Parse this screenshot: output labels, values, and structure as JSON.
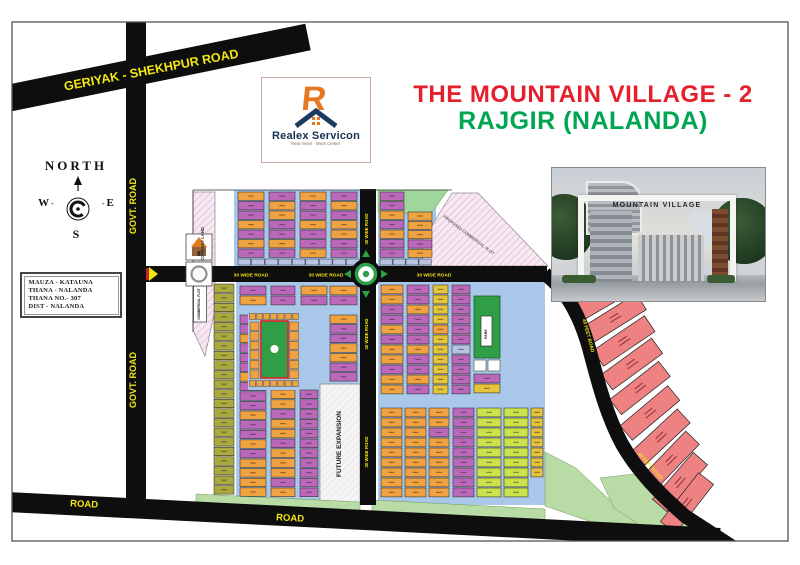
{
  "title": {
    "line1": "THE MOUNTAIN VILLAGE - 2",
    "line2": "RAJGIR (NALANDA)"
  },
  "logo": {
    "name": "Realex Servicon",
    "tagline": "Real Asset - Work Center"
  },
  "compass": {
    "north": "NORTH",
    "w": "W",
    "e": "E",
    "s": "S"
  },
  "info": {
    "lines": [
      "MAUZA - KATAUNA",
      "THANA - NALANDA",
      "THANA NO.- 307",
      "DIST - NALANDA"
    ]
  },
  "photo": {
    "caption": "MOUNTAIN VILLAGE"
  },
  "map": {
    "frame": {
      "x": 12,
      "y": 22,
      "w": 776,
      "h": 519
    },
    "colors": {
      "O": "#efa23f",
      "P": "#bb68bb",
      "Y": "#e5c33c",
      "G": "#cbe24a",
      "D": "#aaa83e",
      "R": "#ee8282",
      "B": "#a9c8e9",
      "L": "#b9c3e4",
      "W": "#ffffff",
      "LG": "#b9dca6",
      "LG2": "#9fd69b",
      "GR": "#2f9e47"
    },
    "blue_bgs": [
      [
        234,
        190,
        126,
        76
      ],
      [
        378,
        190,
        58,
        76
      ],
      [
        236,
        282,
        124,
        223
      ],
      [
        378,
        282,
        167,
        223
      ]
    ],
    "hatch_areas": [
      {
        "p": "pink",
        "pts": "193,192 215,192 215,310 205,356 193,330"
      },
      {
        "p": "pink",
        "pts": "423,266 423,240 452,193 478,193 548,266"
      },
      {
        "p": "pink",
        "pts": "548,270 575,300 590,330 597,358 589,358 566,306 544,280"
      },
      {
        "p": "gray",
        "pts": "320,384 360,384 360,503 320,503"
      }
    ],
    "green_areas": [
      {
        "f": "LG2",
        "pts": "378,190 448,190 431,214 378,212"
      },
      {
        "f": "LG",
        "pts": "196,494 360,502 360,513 196,507"
      },
      {
        "f": "LG",
        "pts": "372,500 545,509 545,522 372,513"
      },
      {
        "f": "LG",
        "pts": "545,452 576,468 612,502 658,527 638,538 545,506"
      },
      {
        "f": "LG",
        "pts": "600,478 652,472 696,524 658,537 614,508"
      }
    ],
    "strips": [
      {
        "x": 238,
        "y": 259,
        "w": 122,
        "h": 6,
        "n": 9,
        "f": "L"
      },
      {
        "x": 380,
        "y": 259,
        "w": 52,
        "h": 6,
        "n": 4,
        "f": "L"
      }
    ],
    "columns": [
      {
        "x": 238,
        "y": 192,
        "w": 26,
        "rh": 9.5,
        "pat": "OPPOPOP"
      },
      {
        "x": 269,
        "y": 192,
        "w": 26,
        "rh": 9.5,
        "pat": "POOPPOP"
      },
      {
        "x": 300,
        "y": 192,
        "w": 26,
        "rh": 9.5,
        "pat": "OPPOPPO"
      },
      {
        "x": 331,
        "y": 192,
        "w": 26,
        "rh": 9.5,
        "pat": "POPOOPP"
      },
      {
        "x": 380,
        "y": 192,
        "w": 24,
        "rh": 9.5,
        "pat": "PPOPOPP"
      },
      {
        "x": 408,
        "y": 212,
        "w": 24,
        "rh": 9.3,
        "pat": "OOOPO"
      },
      {
        "x": 214,
        "y": 284,
        "w": 20,
        "rh": 9.6,
        "pat": "DDDDDDDDDDDDDDDDDDDDDD"
      },
      {
        "x": 240,
        "y": 286,
        "w": 26,
        "rh": 10,
        "pat": "PO"
      },
      {
        "x": 271,
        "y": 286,
        "w": 24,
        "rh": 10,
        "pat": "PP"
      },
      {
        "x": 301,
        "y": 286,
        "w": 26,
        "rh": 10,
        "pat": "OP"
      },
      {
        "x": 330,
        "y": 286,
        "w": 27,
        "rh": 10,
        "pat": "OP"
      },
      {
        "x": 240,
        "y": 315,
        "w": 26,
        "rh": 9.6,
        "pat": "PPOPPPOPPPOPPOPOOOO"
      },
      {
        "x": 330,
        "y": 315,
        "w": 27,
        "rh": 9.6,
        "pat": "OPPOOPP"
      },
      {
        "x": 271,
        "y": 390,
        "w": 24,
        "rh": 9.8,
        "pat": "OOPOOPOOOPO"
      },
      {
        "x": 300,
        "y": 390,
        "w": 18,
        "rh": 9.8,
        "pat": "PPPPPPPPPPP"
      },
      {
        "x": 381,
        "y": 285,
        "w": 22,
        "rh": 10,
        "pat": "OOPPOPOOPOO"
      },
      {
        "x": 407,
        "y": 285,
        "w": 22,
        "rh": 10,
        "pat": "PPOPPPOPPOP"
      },
      {
        "x": 433,
        "y": 285,
        "w": 15,
        "rh": 10,
        "pat": "YYYYOYYYYYY"
      },
      {
        "x": 452,
        "y": 285,
        "w": 18,
        "rh": 10,
        "pat": "PPPPPPLPPPP"
      },
      {
        "x": 474,
        "y": 374,
        "w": 26,
        "rh": 10,
        "pat": "PY"
      },
      {
        "x": 381,
        "y": 408,
        "w": 21,
        "rh": 10,
        "pat": "OOOOOOOOO"
      },
      {
        "x": 405,
        "y": 408,
        "w": 21,
        "rh": 10,
        "pat": "OOOOOOOOO"
      },
      {
        "x": 429,
        "y": 408,
        "w": 20,
        "rh": 10,
        "pat": "OOPOOOOOO"
      },
      {
        "x": 453,
        "y": 408,
        "w": 21,
        "rh": 10,
        "pat": "PPPPPPPPP"
      },
      {
        "x": 477,
        "y": 408,
        "w": 24,
        "rh": 10,
        "pat": "GGGGGGGGG"
      },
      {
        "x": 504,
        "y": 408,
        "w": 24,
        "rh": 10,
        "pat": "GGGGGGGGG"
      },
      {
        "x": 531,
        "y": 408,
        "w": 12,
        "rh": 10,
        "pat": "YYYYYYY"
      }
    ],
    "cells": [
      [
        474,
        360,
        12,
        11,
        "W"
      ],
      [
        488,
        360,
        12,
        11,
        "W"
      ]
    ],
    "park": {
      "bg": [
        248,
        312,
        52,
        78
      ],
      "green": [
        261,
        321,
        27,
        57
      ],
      "circle": [
        274.5,
        349,
        4
      ]
    },
    "green_plot": [
      474,
      296,
      26,
      62
    ],
    "white_boxes": [
      [
        193.5,
        286,
        13,
        36
      ],
      [
        481,
        316,
        11,
        30
      ]
    ],
    "farm": {
      "w": 62,
      "h": 19,
      "plots": [
        [
          606,
          296,
          -30
        ],
        [
          615,
          318,
          -32
        ],
        [
          624,
          341,
          -34
        ],
        [
          632,
          364,
          -36
        ],
        [
          640,
          388,
          -38
        ],
        [
          650,
          413,
          -40
        ],
        [
          661,
          437,
          -43
        ],
        [
          671,
          460,
          -46
        ],
        [
          680,
          482,
          -49
        ],
        [
          687,
          503,
          -52
        ]
      ]
    },
    "road_lines": [
      {
        "x1": -5,
        "y1": 101,
        "x2": 308,
        "y2": 37,
        "w": 27
      },
      {
        "x1": 136,
        "y1": 22,
        "x2": 136,
        "y2": 514,
        "w": 20
      },
      {
        "x1": 146,
        "y1": 274,
        "x2": 547,
        "y2": 274,
        "w": 16
      },
      {
        "x1": 368,
        "y1": 189,
        "x2": 368,
        "y2": 505,
        "w": 16
      },
      {
        "d": "M 8,502 L 720,538",
        "w": 20
      },
      {
        "d": "M 545,274 C 566,290 580,316 589,348 C 598,382 606,414 622,444 C 638,472 660,494 685,516 L 762,566",
        "w": 14
      }
    ],
    "roundabout": {
      "cx": 366,
      "cy": 274
    },
    "arrows": [
      "351,270 351,278 344,274",
      "381,270 381,278 388,274",
      "362,257 370,257 366,250",
      "362,291 370,291 366,298"
    ],
    "lines": [
      [
        193,
        190,
        452,
        190
      ],
      [
        193,
        190,
        193,
        332
      ]
    ],
    "labels": [
      {
        "t": "GERIYAK - SHEKHPUR ROAD",
        "x": 152,
        "y": 74,
        "r": -10.8,
        "s": 12.5
      },
      {
        "t": "GOVT. ROAD",
        "x": 136,
        "y": 206,
        "r": -90,
        "s": 9
      },
      {
        "t": "GOVT. ROAD",
        "x": 136,
        "y": 380,
        "r": -90,
        "s": 9
      },
      {
        "t": "ROAD",
        "x": 84,
        "y": 507,
        "r": 2.9,
        "s": 9.5
      },
      {
        "t": "ROAD",
        "x": 290,
        "y": 521,
        "r": 2.9,
        "s": 9.5
      },
      {
        "t": "30 WIDE ROAD",
        "x": 251,
        "y": 276.5,
        "r": 0,
        "s": 4.8
      },
      {
        "t": "30 WIDE ROAD",
        "x": 326,
        "y": 276.5,
        "r": 0,
        "s": 4.8
      },
      {
        "t": "30 WIDE ROAD",
        "x": 434,
        "y": 276.5,
        "r": 0,
        "s": 4.8
      },
      {
        "t": "30 WIDE ROAD",
        "x": 368,
        "y": 229,
        "r": -90,
        "s": 4.3
      },
      {
        "t": "30 WIDE ROAD",
        "x": 368,
        "y": 334,
        "r": -90,
        "s": 4.3
      },
      {
        "t": "30 WIDE ROAD",
        "x": 368,
        "y": 452,
        "r": -90,
        "s": 4.3
      },
      {
        "t": "40 FEET ROAD",
        "x": 587,
        "y": 336,
        "r": 75,
        "s": 4.8
      },
      {
        "t": "40 FEET ROAD",
        "x": 649,
        "y": 467,
        "r": 48,
        "s": 4.8
      },
      {
        "t": "COMPANY LAND",
        "x": 204,
        "y": 244,
        "r": -90,
        "s": 4.2,
        "c": "#333333"
      },
      {
        "t": "COMMERCIAL PLOT",
        "x": 200,
        "y": 304,
        "r": -90,
        "s": 3.2,
        "c": "#111111"
      },
      {
        "t": "FUTURE EXPANSION",
        "x": 341,
        "y": 444,
        "r": -90,
        "s": 6.5,
        "c": "#222222"
      },
      {
        "t": "PROPOSED COMMERCIAL PLOT",
        "x": 468,
        "y": 236,
        "r": 37,
        "s": 4,
        "c": "#666666"
      },
      {
        "t": "PARK",
        "x": 487,
        "y": 334,
        "r": -90,
        "s": 3.6,
        "c": "#111111"
      }
    ]
  }
}
